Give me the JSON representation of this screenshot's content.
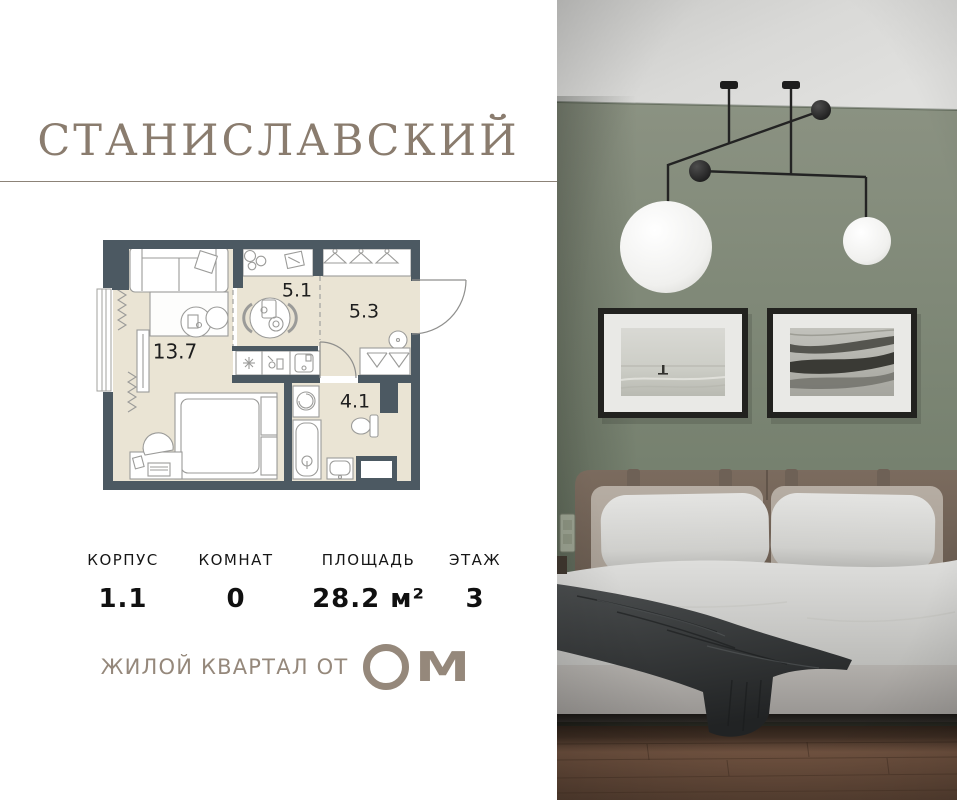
{
  "brand": {
    "title": "СТАНИСЛАВСКИЙ",
    "tagline": "ЖИЛОЙ КВАРТАЛ ОТ",
    "logo": {
      "text": "ОМ",
      "m": "М"
    }
  },
  "floorplan": {
    "rooms": [
      {
        "name": "living-room",
        "area": "13.7"
      },
      {
        "name": "kitchen",
        "area": "5.1"
      },
      {
        "name": "hallway",
        "area": "5.3"
      },
      {
        "name": "bathroom",
        "area": "4.1"
      }
    ]
  },
  "details": {
    "columns": [
      {
        "label": "КОРПУС",
        "value": "1.1"
      },
      {
        "label": "КОМНАТ",
        "value": "0"
      },
      {
        "label": "ПЛОЩАДЬ",
        "value": "28.2 м²"
      },
      {
        "label": "ЭТАЖ",
        "value": "3"
      }
    ]
  },
  "photo": {
    "elements": [
      "pendant-lamp",
      "wall-art-left",
      "wall-art-right",
      "headboard",
      "pillows",
      "duvet",
      "throw-blanket",
      "bed-base",
      "wood-floor",
      "light-switch"
    ]
  },
  "colors": {
    "accent_taupe": "#8a7c6e",
    "plan_wall": "#4c5962",
    "plan_floor": "#eae4d4",
    "photo_wall_green": "#76816e",
    "ceiling_gray": "#d7d7d5",
    "wood_floor": "#6b4f3e",
    "blanket_dark": "#2e3132"
  }
}
